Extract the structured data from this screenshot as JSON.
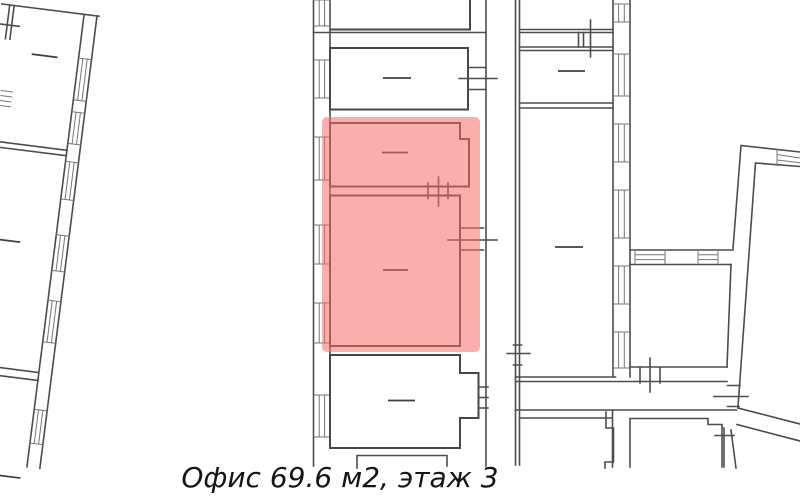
{
  "plan": {
    "caption": "Офис 69.6 м2, этаж 3",
    "office": {
      "area_m2": "69.6",
      "floor": "3"
    }
  },
  "colors": {
    "highlight_fill": "rgba(246,108,108,0.55)",
    "wall_line": "#4c4c4c",
    "hatch_line": "#767676",
    "caption_text": "#151515",
    "background": "#ffffff"
  }
}
